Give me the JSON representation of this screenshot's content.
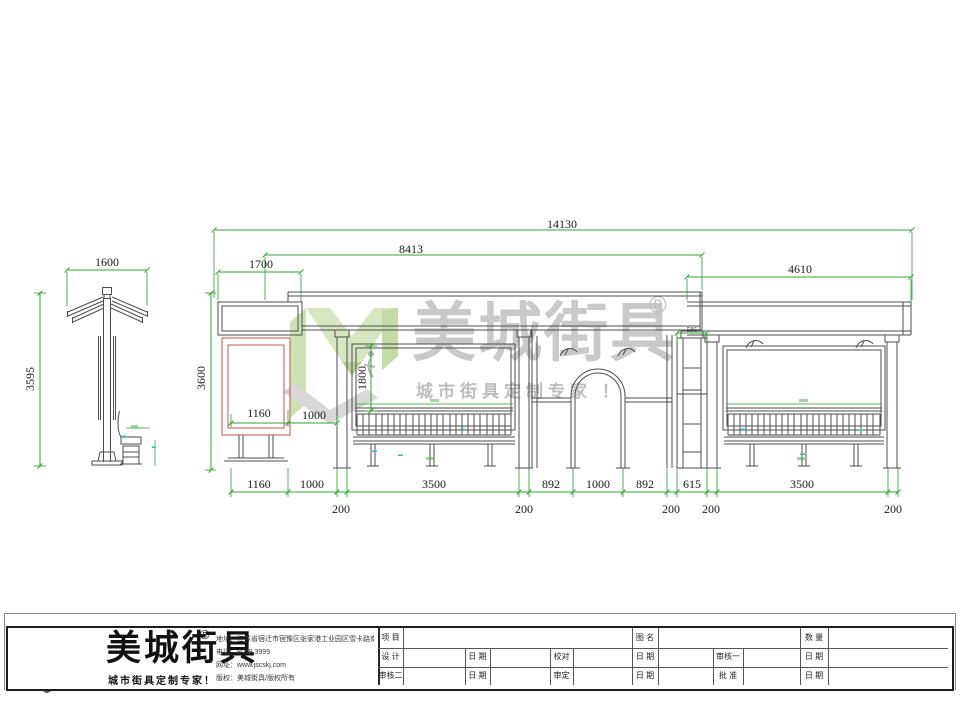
{
  "colors": {
    "dimension_green": "#33a433",
    "highlight_red": "#cc4f4f",
    "line_gray": "#4d4d4d",
    "micro_cyan": "#2fbfbf",
    "logo_green": "#8dc63f",
    "logo_green_dark": "#649e2e",
    "logo_gray": "#58595b",
    "watermark_gray": "#c9c9c9"
  },
  "watermark": {
    "brand": "美城街具",
    "registered": "®",
    "slogan": "城市街具定制专家 ！"
  },
  "side_view": {
    "width": "1600",
    "height": "3595"
  },
  "elevation": {
    "overall_width": "14130",
    "upper_width": "8413",
    "left_canopy": "1700",
    "right_canopy": "4610",
    "height": "3600",
    "opening_height": "1800",
    "sign_width": "1160",
    "sign_offset": "1000",
    "ladder_width": "585",
    "bottom_chain": [
      "1160",
      "1000",
      "3500",
      "892",
      "1000",
      "892",
      "615",
      "3500"
    ],
    "post_widths": [
      "200",
      "200",
      "200",
      "200",
      "200"
    ]
  },
  "footer": {
    "brand": "美城街具",
    "registered": "®",
    "slogan": "城市街具定制专家！",
    "contact": [
      {
        "label": "地址：",
        "value": "江苏省宿迁市宿豫区张家港工业园区雪卡路南侧1号"
      },
      {
        "label": "电话：",
        "value": "8088 3999"
      },
      {
        "label": "网址：",
        "value": "www.jscskj.com"
      },
      {
        "label": "版权：",
        "value": "美城街具/版权所有"
      }
    ],
    "table": {
      "project": "项 目",
      "drawing": "图 名",
      "qty": "数 量",
      "design": "设 计",
      "date": "日 期",
      "proof": "校对",
      "review1": "审核一",
      "review2": "审核二",
      "approve": "审定",
      "ratify": "批 准"
    }
  }
}
